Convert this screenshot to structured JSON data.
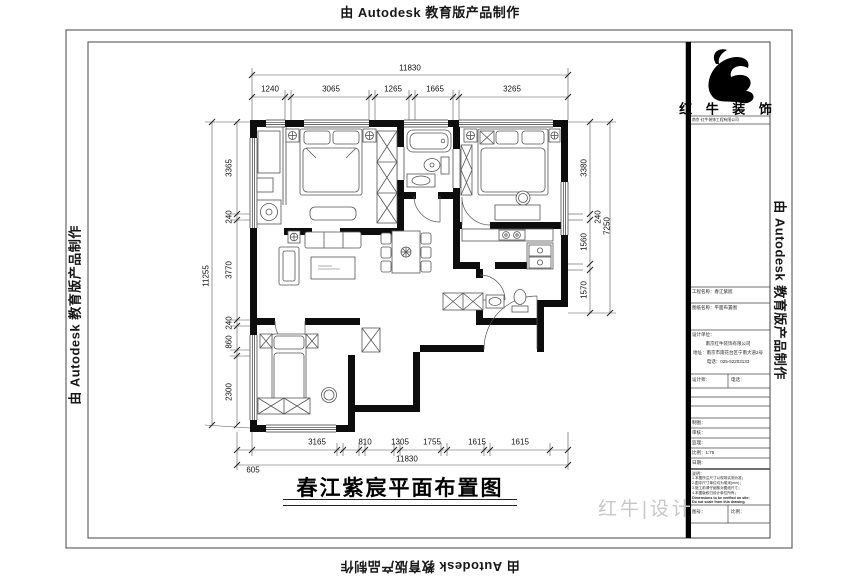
{
  "watermark": {
    "text": "由 Autodesk 教育版产品制作"
  },
  "drawing": {
    "title": "春江紫宸平面布置图",
    "design_mark": "红牛|设计"
  },
  "brand": {
    "name": "红 牛 装 饰",
    "tagline": "南京·红牛装饰工程有限公司",
    "company": "南京红牛装饰有限公司",
    "address": "地址：南京市雨花台区宁南大道2号",
    "phone": "电话：025-52203133"
  },
  "titleblock": {
    "project_row": "工程名称：春江紫宸",
    "sheet_row": "图纸名称：平面布置图",
    "unit_row": "设计单位：",
    "designer_cell": "设计师：",
    "phone_cell": "电话：",
    "info_rows": [
      "制图：",
      "审核：",
      "监理：",
      "比例：1:75",
      "日期："
    ],
    "notes_title": "说明：",
    "notes": [
      "1.本图所注尺寸以现场实测为准；",
      "2.图中尺寸单位均为毫米(mm)；",
      "3.施工前请仔细核对图纸尺寸；",
      "4.本图版权归设计单位所有；",
      "Dimensions to be verified on site;",
      "Do not scale from this drawing."
    ],
    "sheet_no_cell": "图号：",
    "scale_cell": "比例："
  },
  "dims": {
    "top": {
      "total": "11830",
      "segments": [
        "1240",
        "3065",
        "1265",
        "1665",
        "3265"
      ]
    },
    "bottom": {
      "total": "11830",
      "start_offset": "605",
      "segments": [
        "3165",
        "810",
        "1305",
        "1755",
        "1615",
        "1615"
      ]
    },
    "left": {
      "total": "11255",
      "segments": [
        "3365",
        "240",
        "3770",
        "240",
        "860",
        "2300"
      ]
    },
    "right": {
      "total": "7250",
      "segments": [
        "3380",
        "240",
        "1560",
        "1570"
      ]
    }
  }
}
